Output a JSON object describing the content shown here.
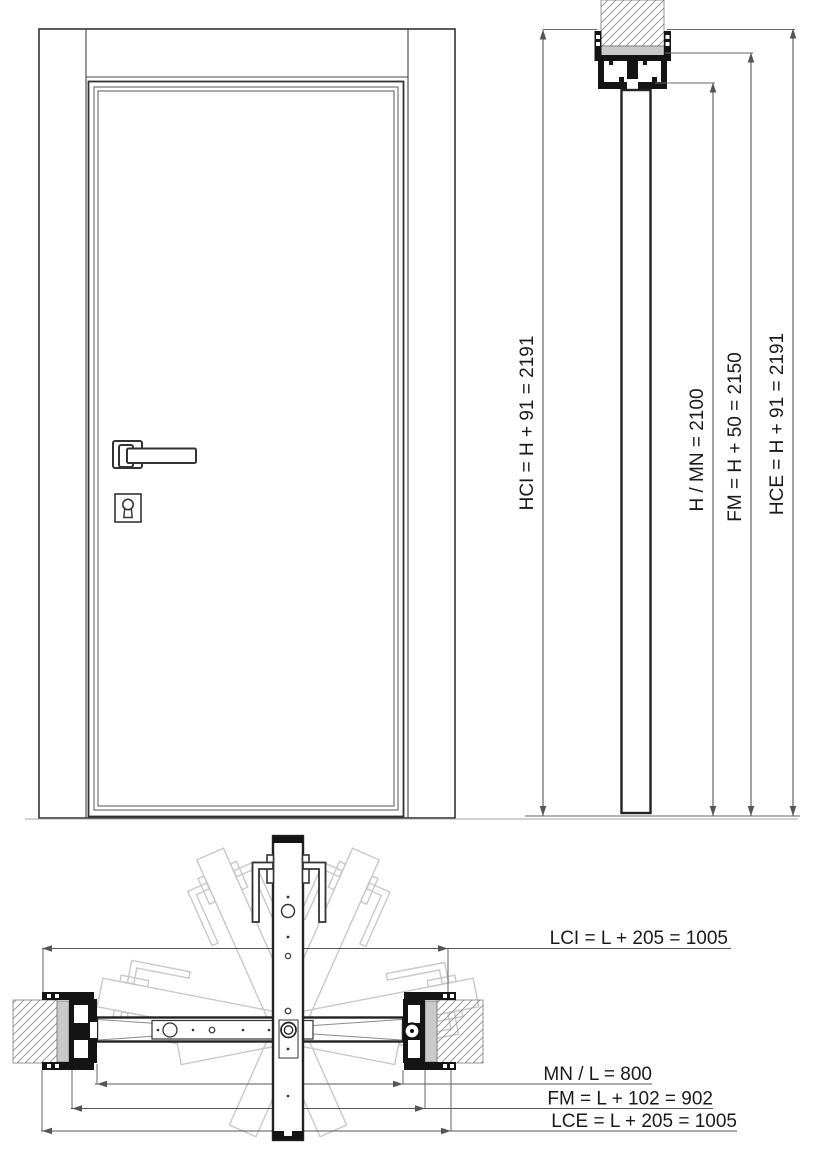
{
  "drawing_type": "door installation technical diagram",
  "dimensions": {
    "vertical": [
      {
        "id": "HCI",
        "label": "HCI = H + 91 = 2191",
        "formula": "H + 91",
        "value": 2191
      },
      {
        "id": "H_MN",
        "label": "H / MN = 2100",
        "value": 2100
      },
      {
        "id": "FM_V",
        "label": "FM = H + 50 = 2150",
        "formula": "H + 50",
        "value": 2150
      },
      {
        "id": "HCE",
        "label": "HCE = H + 91 = 2191",
        "formula": "H + 91",
        "value": 2191
      }
    ],
    "horizontal": [
      {
        "id": "LCI",
        "label": "LCI = L + 205 = 1005",
        "formula": "L + 205",
        "value": 1005
      },
      {
        "id": "MN_L",
        "label": "MN / L = 800",
        "value": 800
      },
      {
        "id": "FM_H",
        "label": "FM = L + 102 = 902",
        "formula": "L + 102",
        "value": 902
      },
      {
        "id": "LCE",
        "label": "LCE = L + 205 = 1005",
        "formula": "L + 205",
        "value": 1005
      }
    ]
  },
  "colors": {
    "line": "#222222",
    "dimension_line": "#555555",
    "ghost": "#c8c8c8",
    "wall_band": "#c9c9c9",
    "text": "#1a1a1a"
  }
}
